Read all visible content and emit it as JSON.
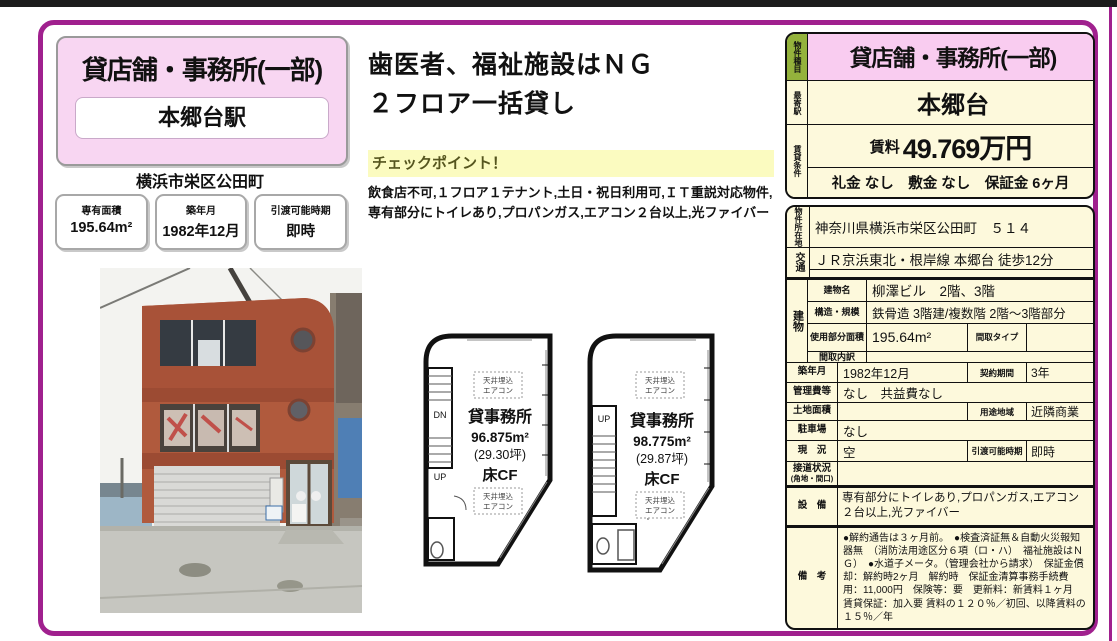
{
  "left_panel": {
    "category": "貸店舗・事務所(一部)",
    "station": "本郷台駅",
    "address": "横浜市栄区公田町",
    "stats": [
      {
        "label": "専有面積",
        "value": "195.64m²"
      },
      {
        "label": "築年月",
        "value": "1982年12月"
      },
      {
        "label": "引渡可能時期",
        "value": "即時"
      }
    ]
  },
  "headline": {
    "line1": "歯医者、福祉施設はＮＧ",
    "line2": "２フロア一括貸し",
    "checkpoint_title": "チェックポイント！",
    "checkpoint_body": "飲食店不可,１フロア１テナント,土日・祝日利用可,ＩＴ重説対応物件,専有部分にトイレあり,プロパンガス,エアコン２台以上,光ファイバー"
  },
  "summary_table": {
    "type_label": "物件種目",
    "type_value": "貸店舗・事務所(一部)",
    "station_label": "最寄駅",
    "station_value": "本郷台",
    "terms_label": "賃貸条件",
    "rent_label": "賃料",
    "rent_value": "49.769万円",
    "fees_value": "礼金 なし　敷金 なし　保証金 6ヶ月"
  },
  "detail_table": {
    "location_label": "物件所在地",
    "location_value": "神奈川県横浜市栄区公田町　５１４",
    "transport_label": "交通",
    "transport_value": "ＪＲ京浜東北・根岸線 本郷台 徒歩12分",
    "transport_value2": "",
    "building_label": "建物",
    "building_name_label": "建物名",
    "building_name": "柳澤ビル　2階、3階",
    "structure_label": "構造・規模",
    "structure_value": "鉄骨造 3階建/複数階 2階～3階部分",
    "area_label": "使用部分面積",
    "area_value": "195.64m²",
    "plan_type_label": "間取タイプ",
    "plan_type_value": "",
    "plan_detail_label": "間取内訳",
    "plan_detail_value": "",
    "built_label": "築年月",
    "built_value": "1982年12月",
    "contract_label": "契約期間",
    "contract_value": "3年",
    "mgmt_label": "管理費等",
    "mgmt_value": "なし　共益費なし",
    "land_label": "土地面積",
    "land_value": "",
    "zoning_label": "用途地域",
    "zoning_value": "近隣商業",
    "parking_label": "駐車場",
    "parking_value": "なし",
    "status_label": "現　況",
    "status_value": "空",
    "handover_label": "引渡可能時期",
    "handover_value": "即時",
    "road_label": "接道状況",
    "road_label2": "(角地・間口)",
    "road_value": "",
    "equipment_label": "設　備",
    "equipment_value": "専有部分にトイレあり,プロパンガス,エアコン２台以上,光ファイバー",
    "notes_label": "備　考",
    "notes_value": "●解約通告は３ヶ月前。　●検査済証無＆自動火災報知器無　（消防法用途区分６項（ロ・ハ）　福祉施設はＮＧ）　●水道子メータ。（管理会社から請求）　保証金償却：解約時2ヶ月　解約時　保証金清算事務手続費用：11,000円　保険等：要　更新料：新賃料１ヶ月　賃貸保証：加入要 賃料の１２０％／初回、以降賃料の１５％／年"
  },
  "floorplans": [
    {
      "use": "貸事務所",
      "area": "96.875m²",
      "tsubo": "(29.30坪)",
      "floor": "床CF",
      "aircon_line1": "天井埋込",
      "aircon_line2": "エアコン",
      "stair_top": "DN",
      "stair_bottom": "UP"
    },
    {
      "use": "貸事務所",
      "area": "98.775m²",
      "tsubo": "(29.87坪)",
      "floor": "床CF",
      "aircon_line1": "天井埋込",
      "aircon_line2": "エアコン",
      "stair_top": "UP",
      "stair_bottom": ""
    }
  ]
}
